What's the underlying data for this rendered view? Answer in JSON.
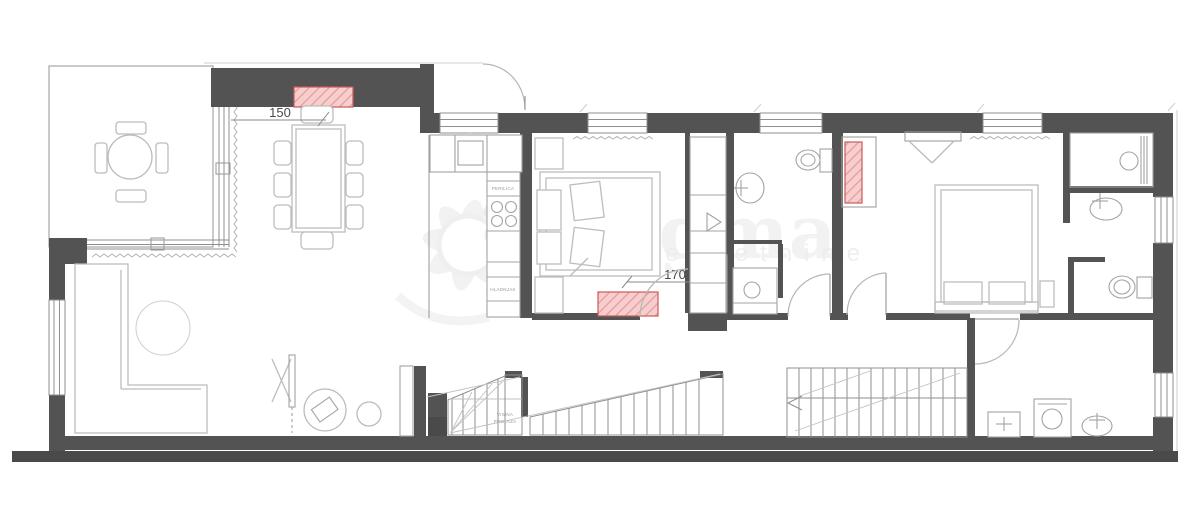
{
  "plan": {
    "title": "apartment-floor-plan",
    "dimensions": {
      "dining": "150",
      "bedroom1_door": "170"
    },
    "kitchen_labels": {
      "upper": "PERILICA",
      "lower": "HLADNJAK"
    },
    "stair_note": {
      "line1": "VISINA",
      "line2": "PROLAZA"
    },
    "watermark": {
      "brand": "Dogma",
      "tagline": "nekretnine"
    },
    "colors": {
      "wall": "#535353",
      "wall_outer": "#4a4a4a",
      "radiator_fill": "#f7cdcd",
      "radiator_hatch": "#e39b9b",
      "radiator_border": "#c75a5a",
      "furniture_line": "#bcbcbc",
      "fixture_line": "#a3a3a3",
      "watermark_gray": "#d8d8d8"
    }
  }
}
